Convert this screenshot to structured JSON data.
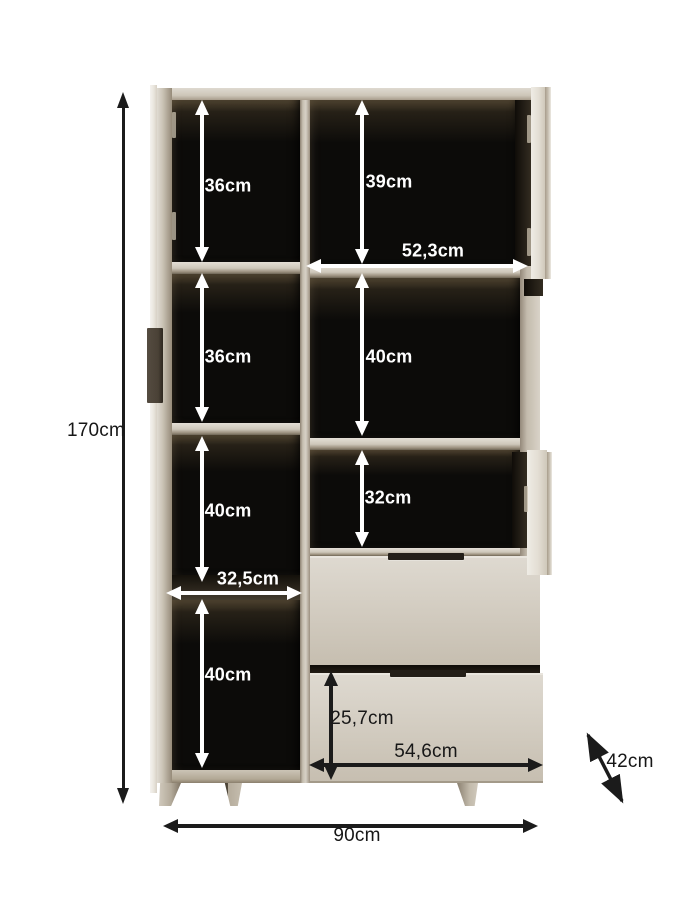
{
  "diagram": {
    "kind": "furniture-dimension-diagram"
  },
  "colors": {
    "background": "#ffffff",
    "body_beige": "#cfc8bb",
    "interior_black": "#0c0b09",
    "handle_dark": "#231e18",
    "arrow_white": "#ffffff",
    "arrow_black": "#1b1b1b"
  },
  "dimensions": {
    "total_height": "170cm",
    "total_width": "90cm",
    "depth": "42cm",
    "left_column_compartments": [
      "36cm",
      "36cm",
      "40cm",
      "40cm"
    ],
    "left_column_inner_width": "32,5cm",
    "right_column_compartments": [
      "39cm",
      "40cm",
      "32cm"
    ],
    "right_column_inner_width": "52,3cm",
    "drawer_inner_height": "25,7cm",
    "drawer_inner_width": "54,6cm"
  }
}
